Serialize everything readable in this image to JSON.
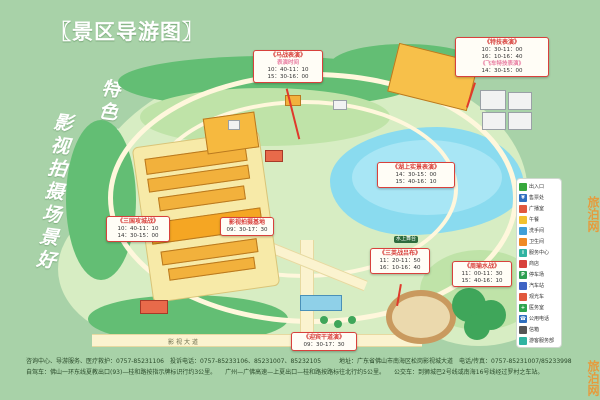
{
  "page": {
    "background": "#a8d2a8",
    "accent_red": "#d8413c",
    "accent_orange": "#f0922b"
  },
  "title": "〖景区导游图〗",
  "slogans": {
    "right_column": "特色旅游乐趣多",
    "left_column": "影视拍摄场景好"
  },
  "watermark": "旅泊网",
  "map_labels": {
    "road": "影视大道",
    "water_stage": "水上舞台"
  },
  "shows": [
    {
      "title": "《马战表演》",
      "sub": "表演时间",
      "lines": [
        "10：40-11：10",
        "15：30-16：00"
      ]
    },
    {
      "title": "《特技表演》",
      "lines": [
        "10：30-11：00",
        "16：10-16：40"
      ],
      "sub2": "《飞车特技表演》",
      "subline": "14：30-15：00"
    },
    {
      "title": "《三国攻城战》",
      "lines": [
        "10：40-11：10",
        "14：30-15：00"
      ]
    },
    {
      "title": "影视拍摄基地",
      "lines": [
        "09：30-17：30"
      ]
    },
    {
      "title": "《湖上实景表演》",
      "lines": [
        "14：30-15：00",
        "15：40-16：10"
      ]
    },
    {
      "title": "《三英战吕布》",
      "lines": [
        "11：20-11：50",
        "16：10-16：40"
      ]
    },
    {
      "title": "《周瑜水战》",
      "lines": [
        "11：00-11：30",
        "15：40-16：10"
      ]
    },
    {
      "title": "《迎宾干道演》",
      "lines": [
        "09：30-17：30"
      ]
    }
  ],
  "legend": {
    "items": [
      {
        "label": "出入口",
        "color": "#37a83c",
        "glyph": ""
      },
      {
        "label": "售票处",
        "color": "#2f6fbf",
        "glyph": "¥"
      },
      {
        "label": "广播室",
        "color": "#e1583e",
        "glyph": ""
      },
      {
        "label": "午餐",
        "color": "#f2c12e",
        "glyph": ""
      },
      {
        "label": "洗手间",
        "color": "#3f9fd8",
        "glyph": ""
      },
      {
        "label": "卫生间",
        "color": "#ef8a25",
        "glyph": ""
      },
      {
        "label": "服务中心",
        "color": "#2fb3a1",
        "glyph": "i"
      },
      {
        "label": "商店",
        "color": "#d8413c",
        "glyph": ""
      },
      {
        "label": "停车场",
        "color": "#2e9e52",
        "glyph": "P"
      },
      {
        "label": "汽车站",
        "color": "#3e63c4",
        "glyph": ""
      },
      {
        "label": "观光车",
        "color": "#e1583e",
        "glyph": ""
      },
      {
        "label": "医务室",
        "color": "#2ea44d",
        "glyph": "+"
      },
      {
        "label": "公用电话",
        "color": "#2f6fbf",
        "glyph": "☎"
      },
      {
        "label": "信箱",
        "color": "#555555",
        "glyph": ""
      },
      {
        "label": "游客服务部",
        "color": "#2fb3a1",
        "glyph": ""
      }
    ]
  },
  "footer": {
    "line1": "咨询中心、导游服务、医疗救护：0757-85231106　投诉电话：0757-85233106、85231007、85232105　　　地址：广东省佛山市南海区松岗影视城大道　电话/传真：0757-85231007/85233998",
    "line2": "自驾车：佛山一环东线夏教出口(93)—桂和路按指示牌标识行约3公里。　　广州—广佛高速—上夏出口—桂和路按路标往北行约5公里。　　公交车：到狮城巴2号线或南海16号线经过罗村之车站。"
  }
}
